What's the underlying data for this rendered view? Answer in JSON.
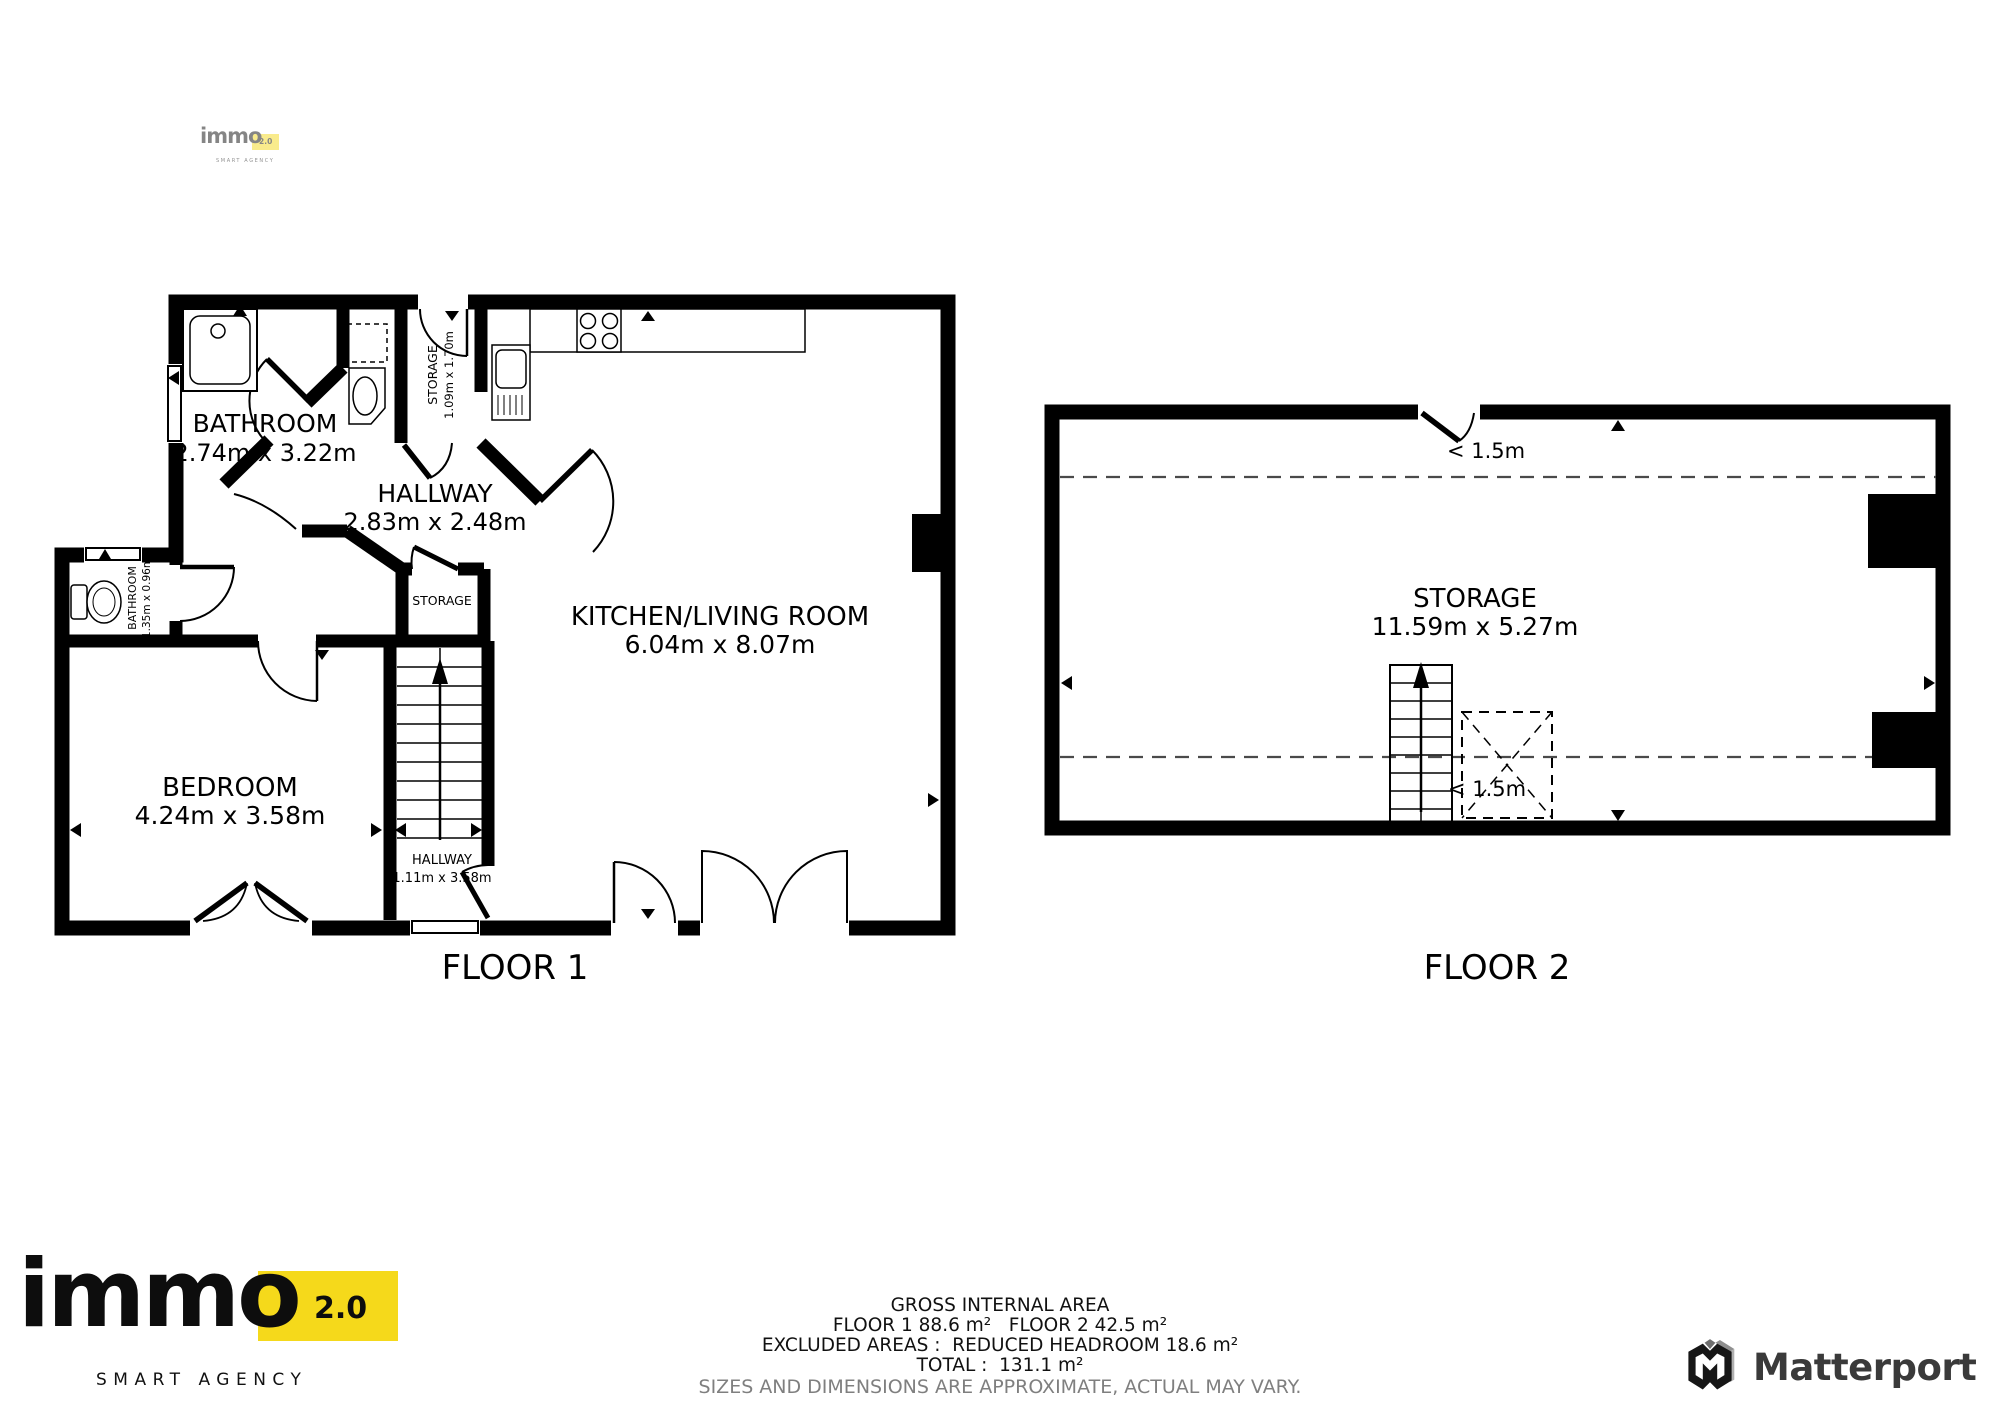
{
  "header_watermark": {
    "brand": "immo",
    "version": "2.0",
    "tagline": "SMART AGENCY"
  },
  "floor1": {
    "label": "FLOOR 1",
    "bathroom": {
      "name": "BATHROOM",
      "dims": "2.74m x 3.22m"
    },
    "hallway": {
      "name": "HALLWAY",
      "dims": "2.83m x 2.48m"
    },
    "kitchen_living": {
      "name": "KITCHEN/LIVING ROOM",
      "dims": "6.04m x 8.07m"
    },
    "bedroom": {
      "name": "BEDROOM",
      "dims": "4.24m x 3.58m"
    },
    "storage_top": {
      "name": "STORAGE",
      "dims": "1.09m x 1.70m"
    },
    "storage_closet": {
      "name": "STORAGE"
    },
    "bathroom_small": {
      "name": "BATHROOM",
      "dims": "1.35m x 0.96m"
    },
    "hallway_lower": {
      "name": "HALLWAY",
      "dims": "1.11m x 3.58m"
    }
  },
  "floor2": {
    "label": "FLOOR 2",
    "storage": {
      "name": "STORAGE",
      "dims": "11.59m x 5.27m"
    },
    "headroom_top": "< 1.5m",
    "headroom_bottom": "< 1.5m"
  },
  "footer": {
    "title": "GROSS INTERNAL AREA",
    "floors": "FLOOR 1 88.6 m²   FLOOR 2 42.5 m²",
    "excluded": "EXCLUDED AREAS :  REDUCED HEADROOM 18.6 m²",
    "total": "TOTAL :  131.1 m²",
    "disclaimer": "SIZES AND DIMENSIONS ARE APPROXIMATE, ACTUAL MAY VARY."
  },
  "brand_logo": {
    "brand": "immo",
    "version": "2.0",
    "tagline": "SMART AGENCY"
  },
  "matterport_label": "Matterport",
  "colors": {
    "accent_yellow": "#F5D91B",
    "wall_black": "#000000",
    "dashed_gray": "#4a4a4a",
    "disclaimer_gray": "#7f7f7f",
    "matterport_gray": "#3a3a3a"
  }
}
